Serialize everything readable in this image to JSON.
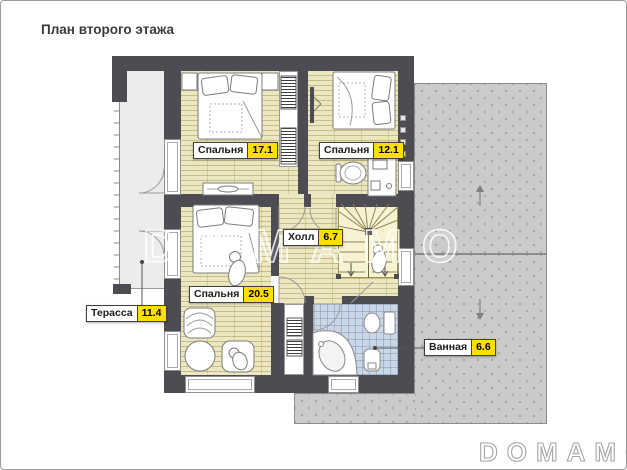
{
  "title": "План второго этажа",
  "watermark": "DOMAMO",
  "logo": "DOMAMO",
  "rooms": [
    {
      "name": "Спальня",
      "area": "17.1"
    },
    {
      "name": "Спальня",
      "area": "12.1"
    },
    {
      "name": "Холл",
      "area": "6.7"
    },
    {
      "name": "Спальня",
      "area": "20.5"
    },
    {
      "name": "Терасса",
      "area": "11.4"
    },
    {
      "name": "Ванная",
      "area": "6.6"
    }
  ],
  "icons": {
    "roof_slope_upper": "arrow-up",
    "roof_slope_lower": "arrow-down"
  },
  "colors": {
    "wall": "#4c4c52",
    "wood_floor": "#ece7c0",
    "stairs_floor": "#f7f3d2",
    "bathroom_tile": "#c9d7e6",
    "terrace": "#ececec",
    "roof": "#cbcbcb",
    "area_badge": "#ffdf00",
    "title_text": "#3a3a3a"
  }
}
